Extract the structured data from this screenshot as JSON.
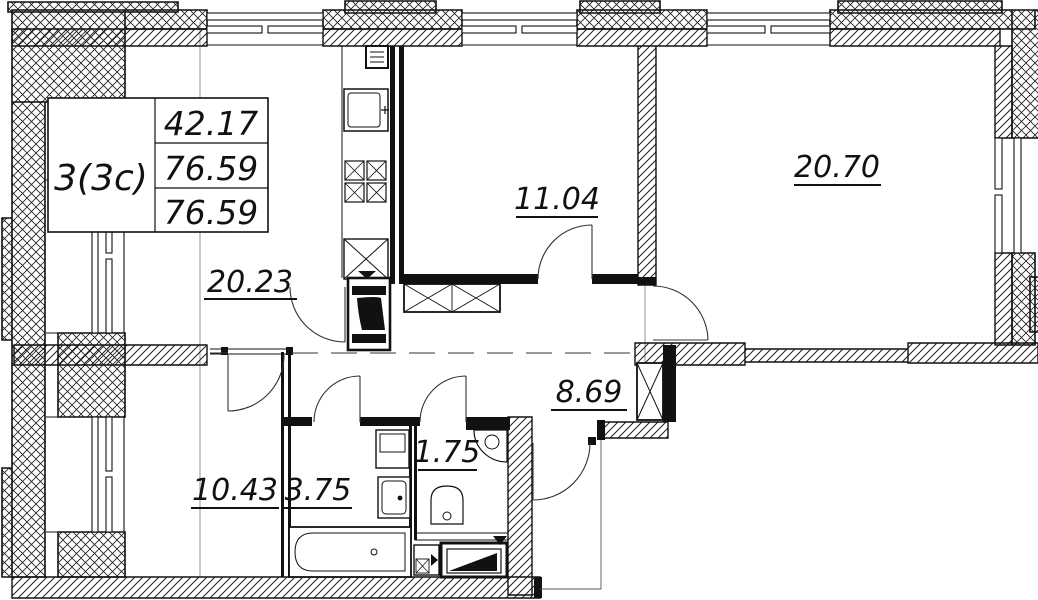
{
  "title_block": {
    "unit": "3(3c)",
    "rows": [
      "42.17",
      "76.59",
      "76.59"
    ]
  },
  "room_areas": {
    "living_kitchen": "20.23",
    "bedroom_small": "11.04",
    "bedroom_large": "20.70",
    "hall": "8.69",
    "bedroom_bottom": "10.43",
    "bathroom": "3.75",
    "wc": "1.75"
  },
  "colors": {
    "line": "#111111",
    "background": "#ffffff"
  }
}
